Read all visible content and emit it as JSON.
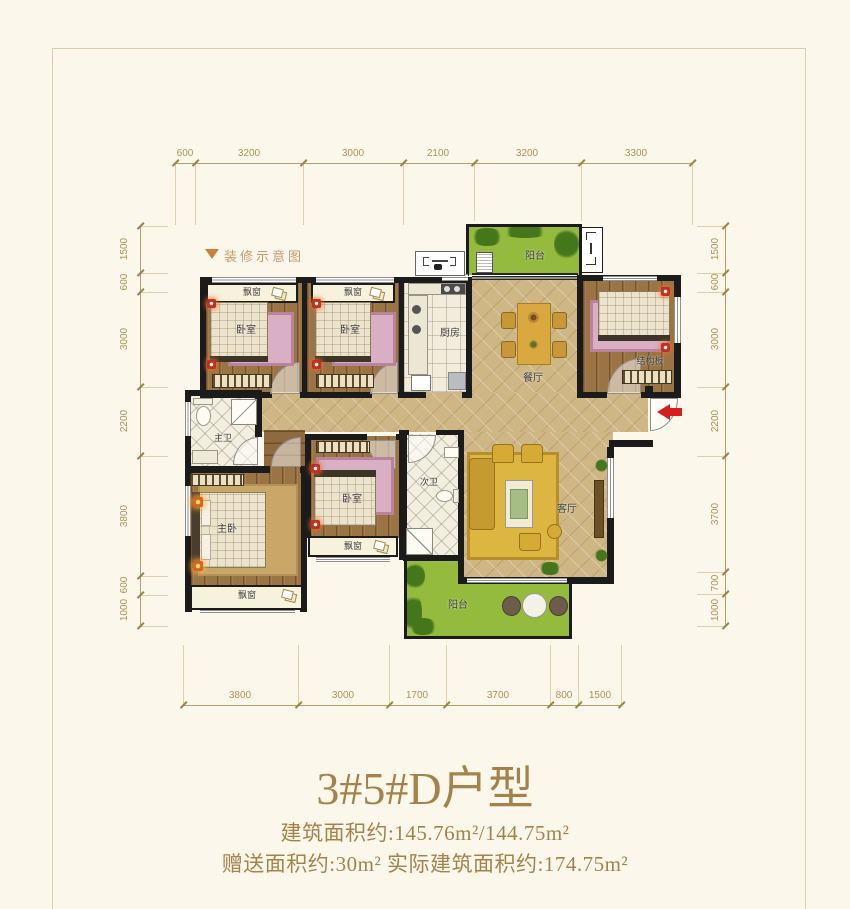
{
  "note": {
    "text": "装修示意图"
  },
  "title": {
    "main": "3#5#D户型",
    "line1": "建筑面积约:145.76m²/144.75m²",
    "line2": "赠送面积约:30m²  实际建筑面积约:174.75m²"
  },
  "dims": {
    "top": [
      "600",
      "3200",
      "3000",
      "2100",
      "3200",
      "3300"
    ],
    "bottom": [
      "3800",
      "3000",
      "1700",
      "3700",
      "800",
      "1500"
    ],
    "left": [
      "1500",
      "600",
      "3000",
      "2200",
      "3800",
      "600",
      "1000"
    ],
    "right": [
      "1500",
      "600",
      "3000",
      "2200",
      "3700",
      "700",
      "1000"
    ]
  },
  "rooms": {
    "bedroom": "卧室",
    "master_bedroom": "主卧",
    "kitchen": "厨房",
    "dining": "餐厅",
    "living": "客厅",
    "master_bath": "主卫",
    "second_bath": "次卫",
    "balcony": "阳台",
    "bay_window": "飘窗",
    "structural_slab": "结构板"
  },
  "colors": {
    "accent_gold": "#a5824a",
    "wall": "#1b1b1b",
    "balcony_green": "#94ba3e",
    "dimension": "#ab9255",
    "entry_arrow": "#d41f1f"
  }
}
